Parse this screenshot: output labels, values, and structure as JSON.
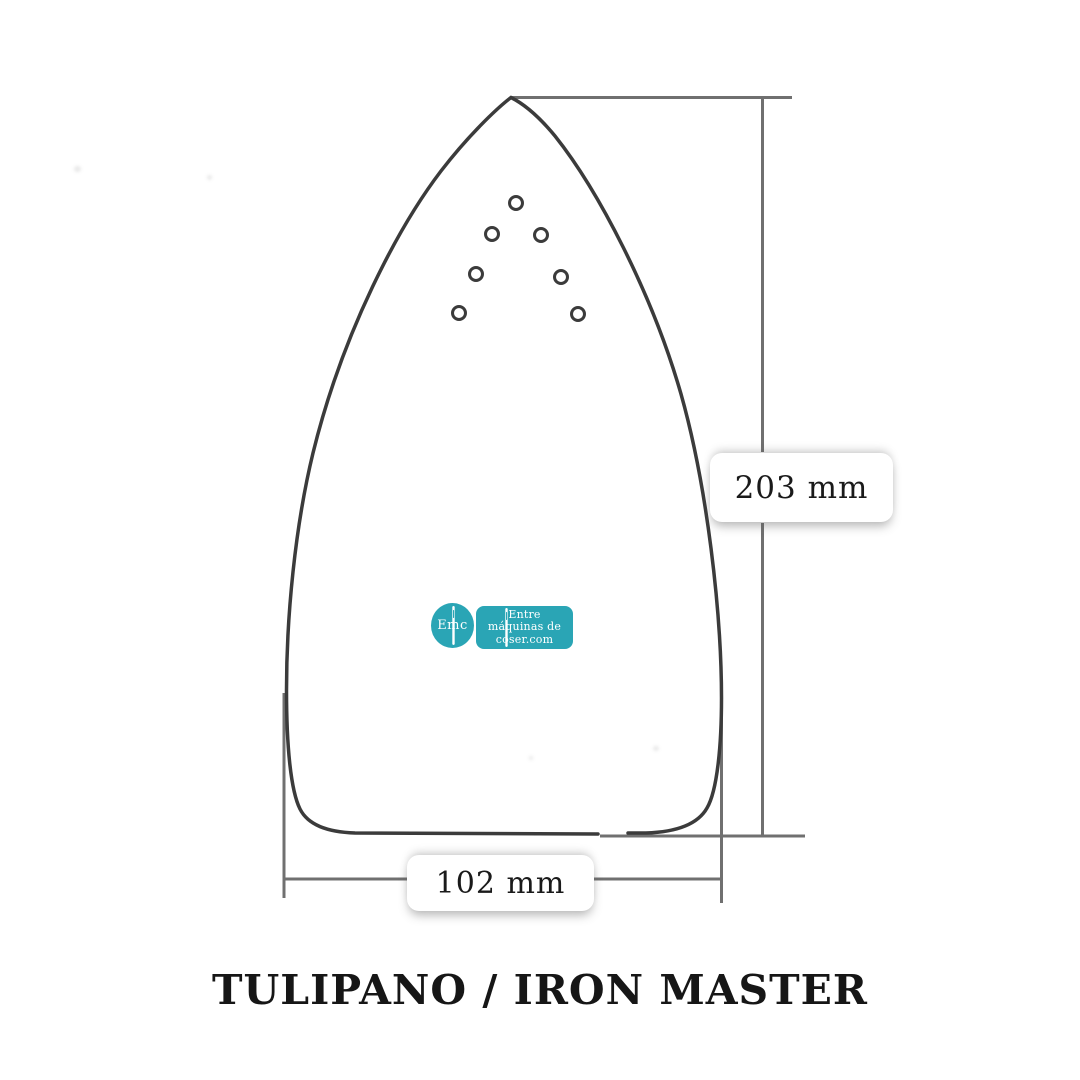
{
  "diagram": {
    "title": "TULIPANO / IRON MASTER",
    "dimensions": {
      "height_label": "203 mm",
      "width_label": "102 mm"
    },
    "steam_holes": 7,
    "colors": {
      "outline": "#3b3b3b",
      "dimension_line": "#707070",
      "pill_background": "#ffffff",
      "label_text": "#1a1a1a",
      "accent_teal": "#2aa5b5"
    }
  },
  "logo": {
    "monogram": "Emc",
    "brand_lines": [
      "Entre",
      "máquinas de",
      "coser.com"
    ]
  }
}
